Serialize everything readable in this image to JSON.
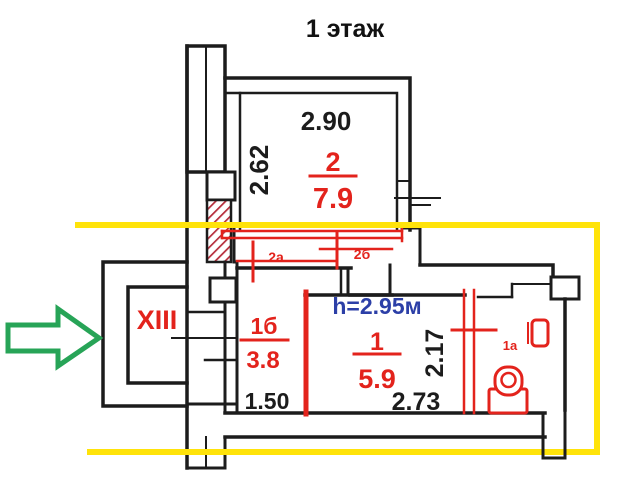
{
  "title": "1 этаж",
  "colors": {
    "walls": "#1c1c1c",
    "red_marking": "#e3231c",
    "hatch_red": "#b52c3a",
    "blue_note": "#2c3fa7",
    "yellow_highlight": "#ffe30a",
    "green_arrow": "#27a457"
  },
  "rooms": {
    "room2": {
      "number": "2",
      "area": "7.9",
      "width_dim": "2.90",
      "depth_dim": "2.62"
    },
    "room1b": {
      "number": "1б",
      "area": "3.8",
      "width_dim": "1.50"
    },
    "room1": {
      "number": "1",
      "area": "5.9",
      "width_dim": "2.73",
      "depth_dim": "2.17",
      "ceiling_height": "h=2.95м"
    },
    "room1a": {
      "number": "1а"
    },
    "corridor": {
      "number": "XIII"
    }
  },
  "door_marks": {
    "mark_2a": "2а",
    "mark_2b": "2б"
  }
}
